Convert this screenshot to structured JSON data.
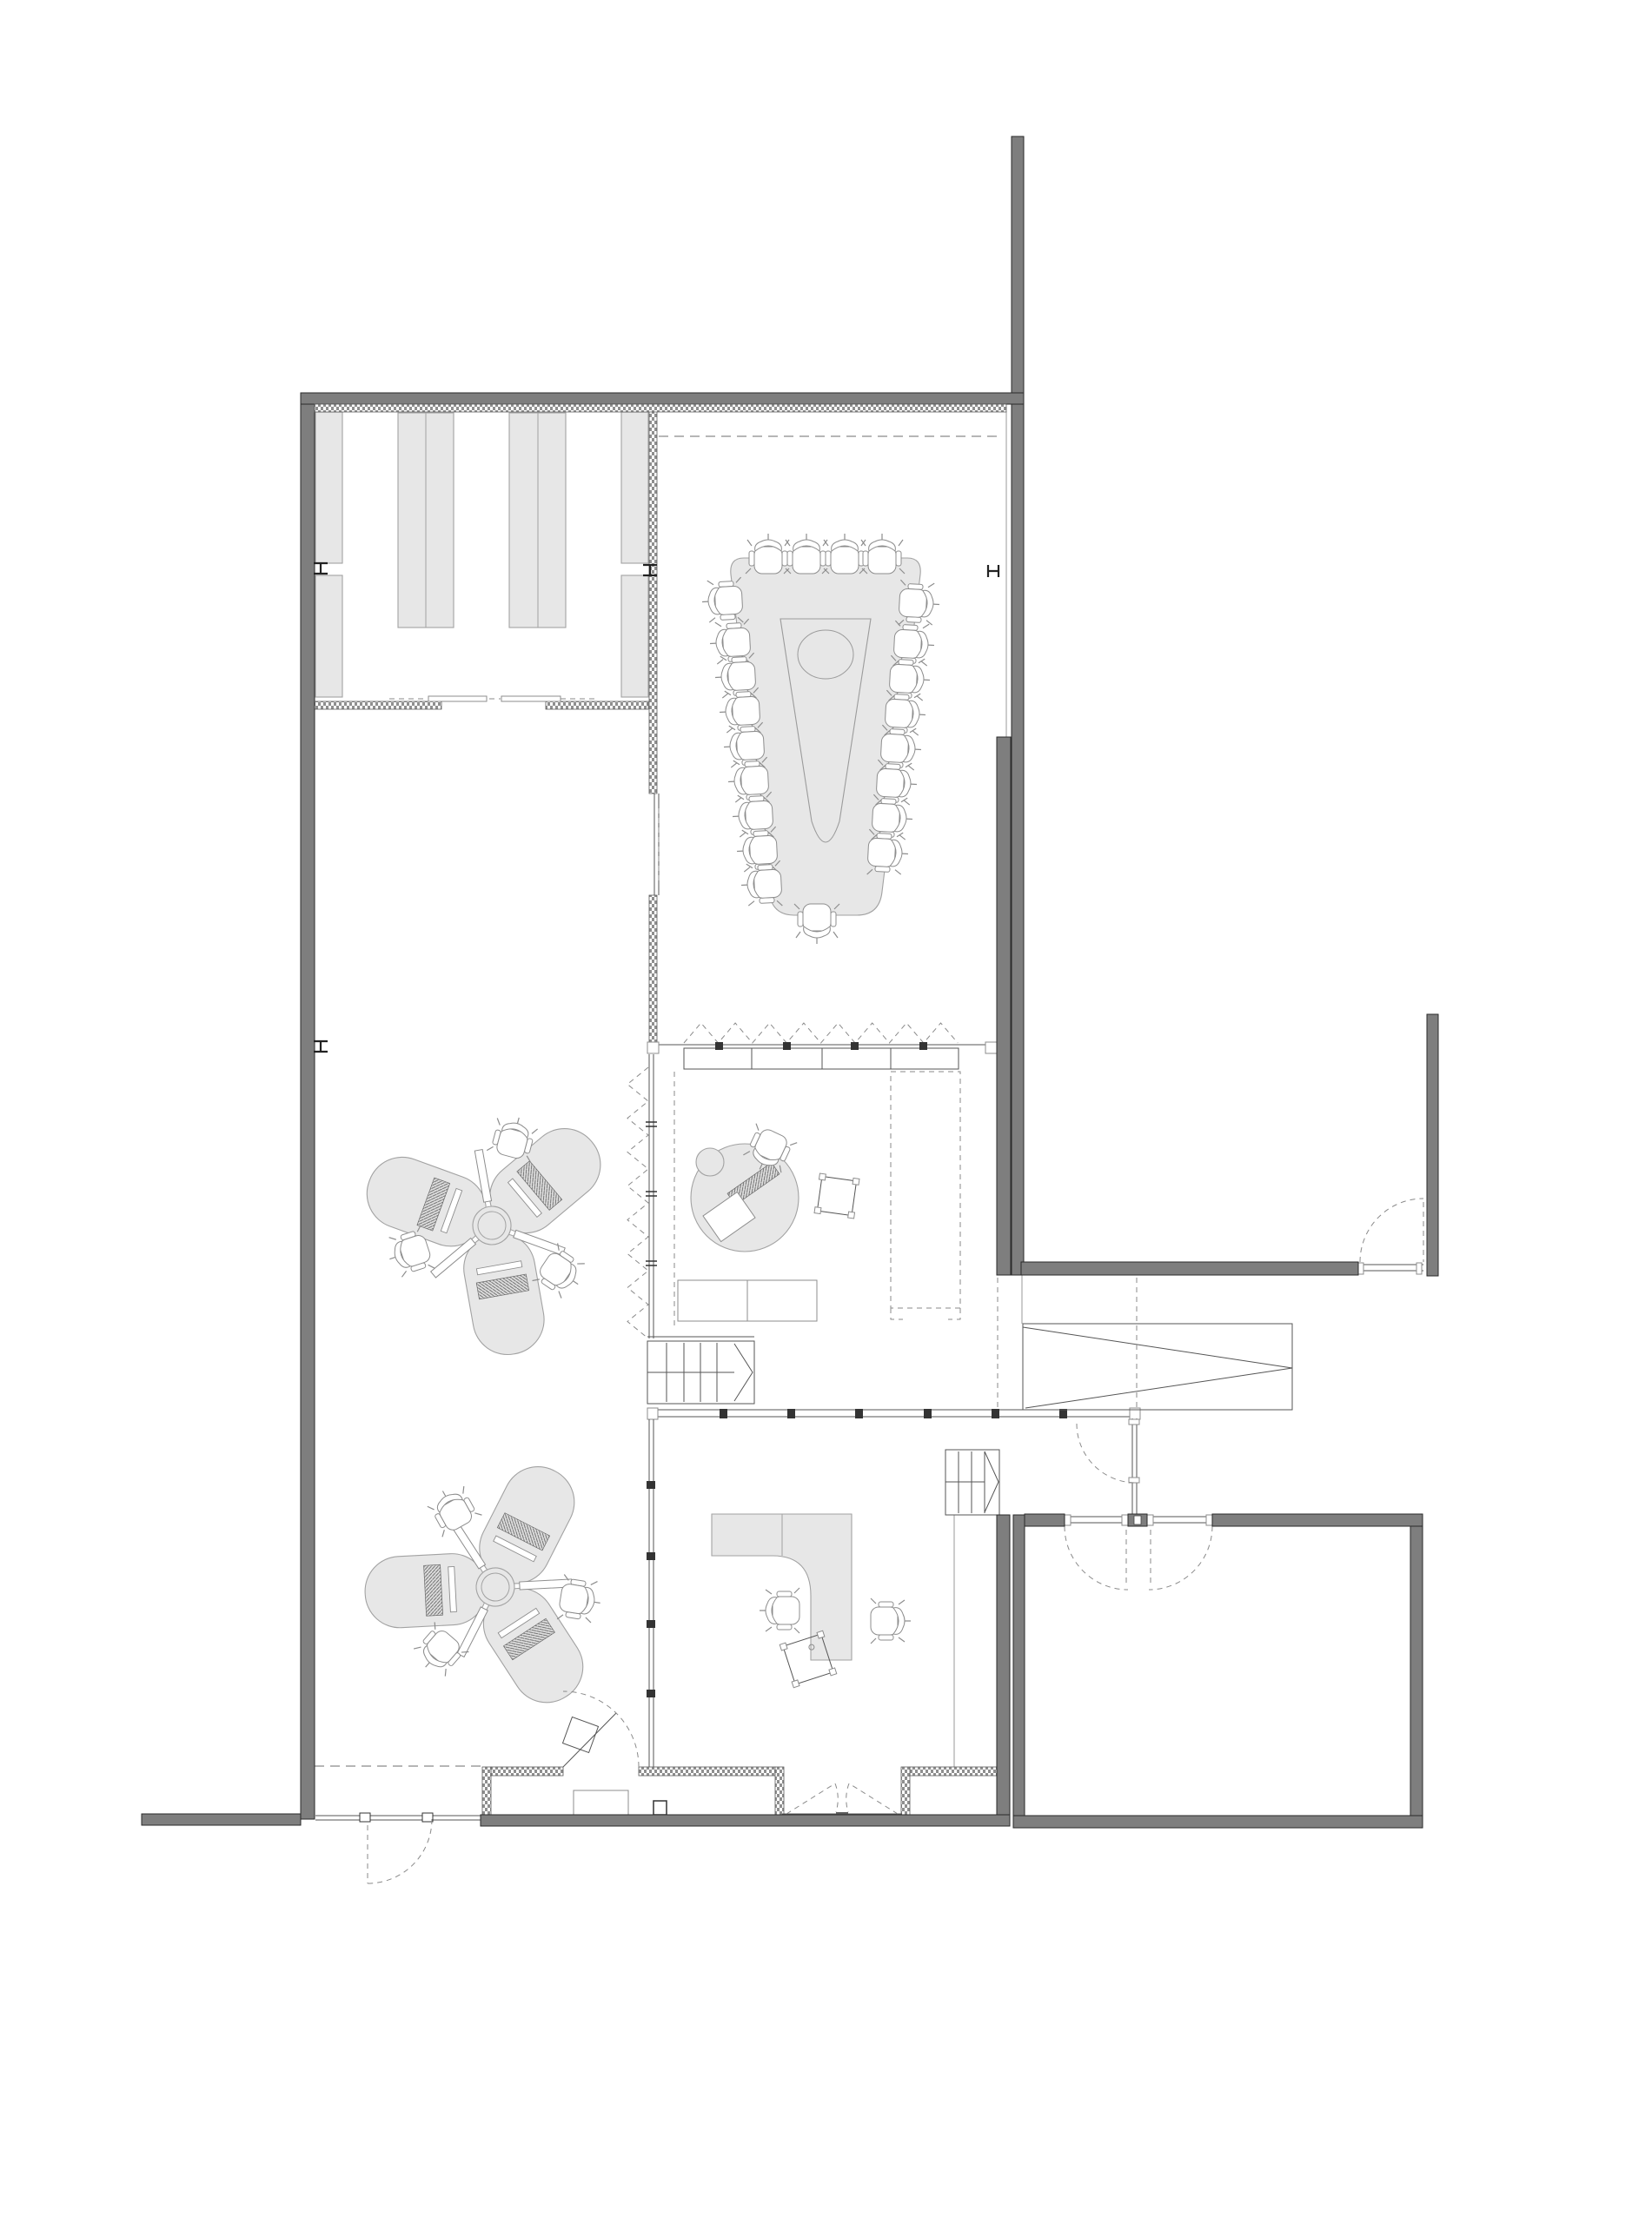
{
  "document": {
    "kind": "architectural-floor-plan",
    "visible_text": [],
    "palette": {
      "background": "#ffffff",
      "wall_fill": "#7e7e7e",
      "wall_edge": "#2a2a2a",
      "insulation_hatch": "#8f8f8f",
      "furniture_fill": "#e7e7e7",
      "furniture_stroke": "#a2a2a2",
      "line": "#555555",
      "light_line": "#9a9a9a",
      "dashed_line": "#8a8a8a"
    },
    "objects": {
      "conference_table_seats": 22,
      "clover_desk_clusters": 2,
      "workstations_per_cluster": 3,
      "meeting_round_table": 1,
      "l_shaped_desk": 1,
      "storage_shelf_units": 6,
      "stairs": 2,
      "ramp": 1,
      "door_swings": 8,
      "folding_partitions": 2
    }
  }
}
